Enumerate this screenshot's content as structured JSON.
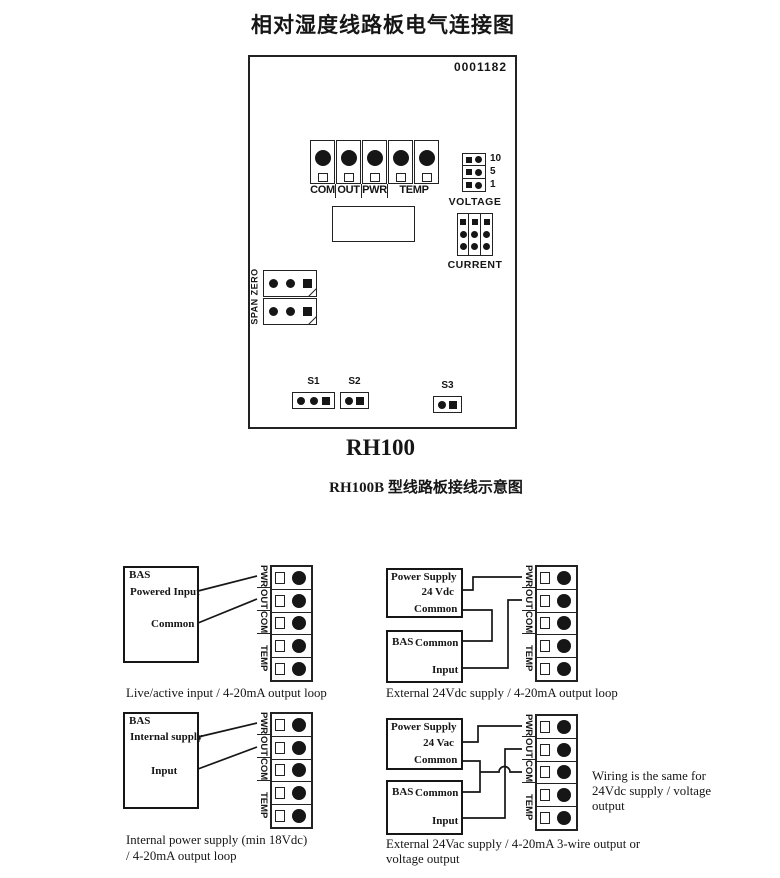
{
  "page": {
    "title": "相对湿度线路板电气连接图"
  },
  "board": {
    "number": "0001182",
    "name": "RH100",
    "caption": "RH100B 型线路板接线示意图",
    "terminals": [
      "COM",
      "OUT",
      "PWR",
      "TEMP"
    ],
    "voltage_label": "VOLTAGE",
    "voltage_values": [
      "10",
      "5",
      "1"
    ],
    "current_label": "CURRENT",
    "span_zero_label": "SPAN ZERO",
    "switches": [
      "S1",
      "S2",
      "S3"
    ]
  },
  "strip": {
    "labels": [
      "PWR",
      "OUT",
      "COM",
      "TEMP"
    ]
  },
  "diagrams": {
    "live_active": {
      "bas_title": "BAS",
      "line1": "Powered Input",
      "line2": "Common",
      "caption": "Live/active input / 4-20mA output loop"
    },
    "external_dc": {
      "ps_title": "Power Supply",
      "ps_voltage": "24 Vdc",
      "ps_common": "Common",
      "bas_title": "BAS",
      "bas_common": "Common",
      "bas_input": "Input",
      "caption": "External 24Vdc supply / 4-20mA output loop"
    },
    "internal": {
      "bas_title": "BAS",
      "line1": "Internal supply",
      "line2": "Input",
      "caption_line1": "Internal power supply (min 18Vdc)",
      "caption_line2": "/ 4-20mA output loop"
    },
    "external_ac": {
      "ps_title": "Power Supply",
      "ps_voltage": "24 Vac",
      "ps_common": "Common",
      "bas_title": "BAS",
      "bas_common": "Common",
      "bas_input": "Input",
      "caption_line1": "External 24Vac supply / 4-20mA 3-wire output or",
      "caption_line2": "voltage output",
      "note_line1": "Wiring is the same for",
      "note_line2": "24Vdc supply / voltage",
      "note_line3": "output"
    }
  }
}
